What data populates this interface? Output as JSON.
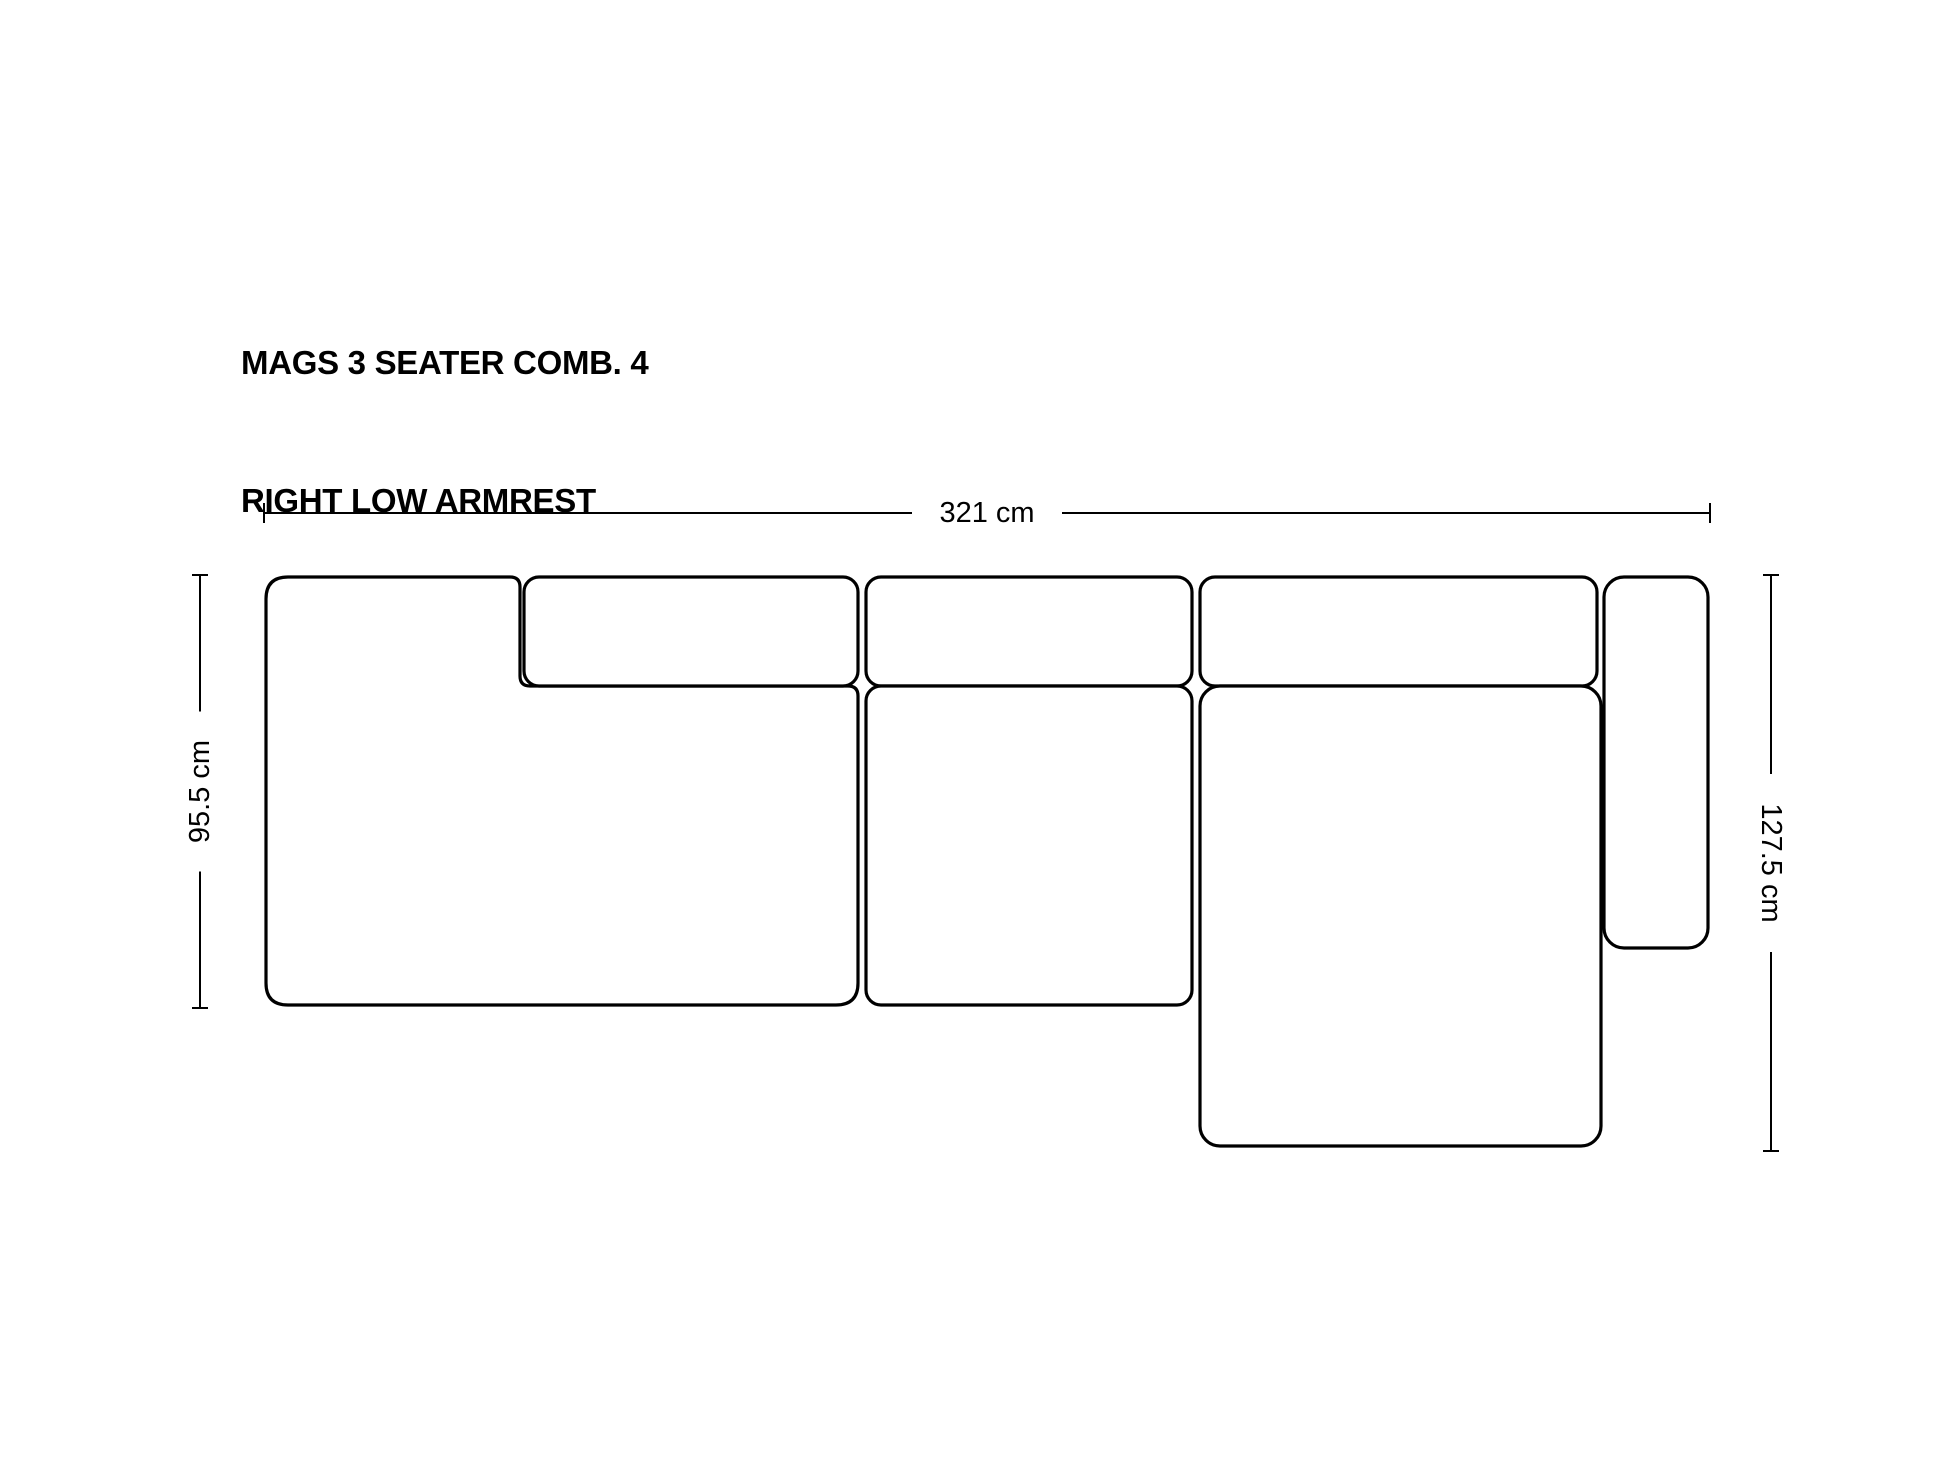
{
  "page": {
    "background": "#ffffff",
    "ink": "#000000"
  },
  "title": {
    "line1": "MAGS 3 SEATER COMB. 4",
    "line2": "RIGHT LOW ARMREST"
  },
  "diagram": {
    "stroke": "#000000",
    "fill": "#ffffff",
    "outline_width": 3.2,
    "dim_line_width": 2,
    "label_font_size": 29,
    "modules": [
      {
        "name": "left-seat-with-low-armrest",
        "shape": "lshape",
        "x": 266,
        "y": 577,
        "w": 592,
        "h": 428,
        "notch_x": 520,
        "notch_y": 686,
        "r": 22,
        "r_inner": 10
      },
      {
        "name": "left-backrest",
        "shape": "rect",
        "x": 524,
        "y": 577,
        "w": 334,
        "h": 109,
        "r": 15
      },
      {
        "name": "middle-backrest",
        "shape": "rect",
        "x": 866,
        "y": 577,
        "w": 326,
        "h": 109,
        "r": 15
      },
      {
        "name": "middle-seat",
        "shape": "rect",
        "x": 866,
        "y": 686,
        "w": 326,
        "h": 319,
        "r": 15
      },
      {
        "name": "right-backrest",
        "shape": "rect",
        "x": 1200,
        "y": 577,
        "w": 397,
        "h": 109,
        "r": 15
      },
      {
        "name": "chaise-longue-seat",
        "shape": "rect",
        "x": 1200,
        "y": 686,
        "w": 401,
        "h": 460,
        "r": 20
      },
      {
        "name": "right-low-armrest",
        "shape": "rect",
        "x": 1604,
        "y": 577,
        "w": 104,
        "h": 371,
        "r": 20
      }
    ],
    "dimensions": [
      {
        "name": "overall-width",
        "label": "321 cm",
        "orientation": "h",
        "x1": 264,
        "x2": 1710,
        "y": 513,
        "tick": 20,
        "gap": 150,
        "rotate": 0
      },
      {
        "name": "left-depth",
        "label": "95.5 cm",
        "orientation": "v",
        "y1": 575,
        "y2": 1008,
        "x": 200,
        "tick": 16,
        "gap": 160,
        "rotate": -90
      },
      {
        "name": "right-depth",
        "label": "127.5 cm",
        "orientation": "v",
        "y1": 575,
        "y2": 1151,
        "x": 1771,
        "tick": 16,
        "gap": 178,
        "rotate": 90
      }
    ]
  }
}
